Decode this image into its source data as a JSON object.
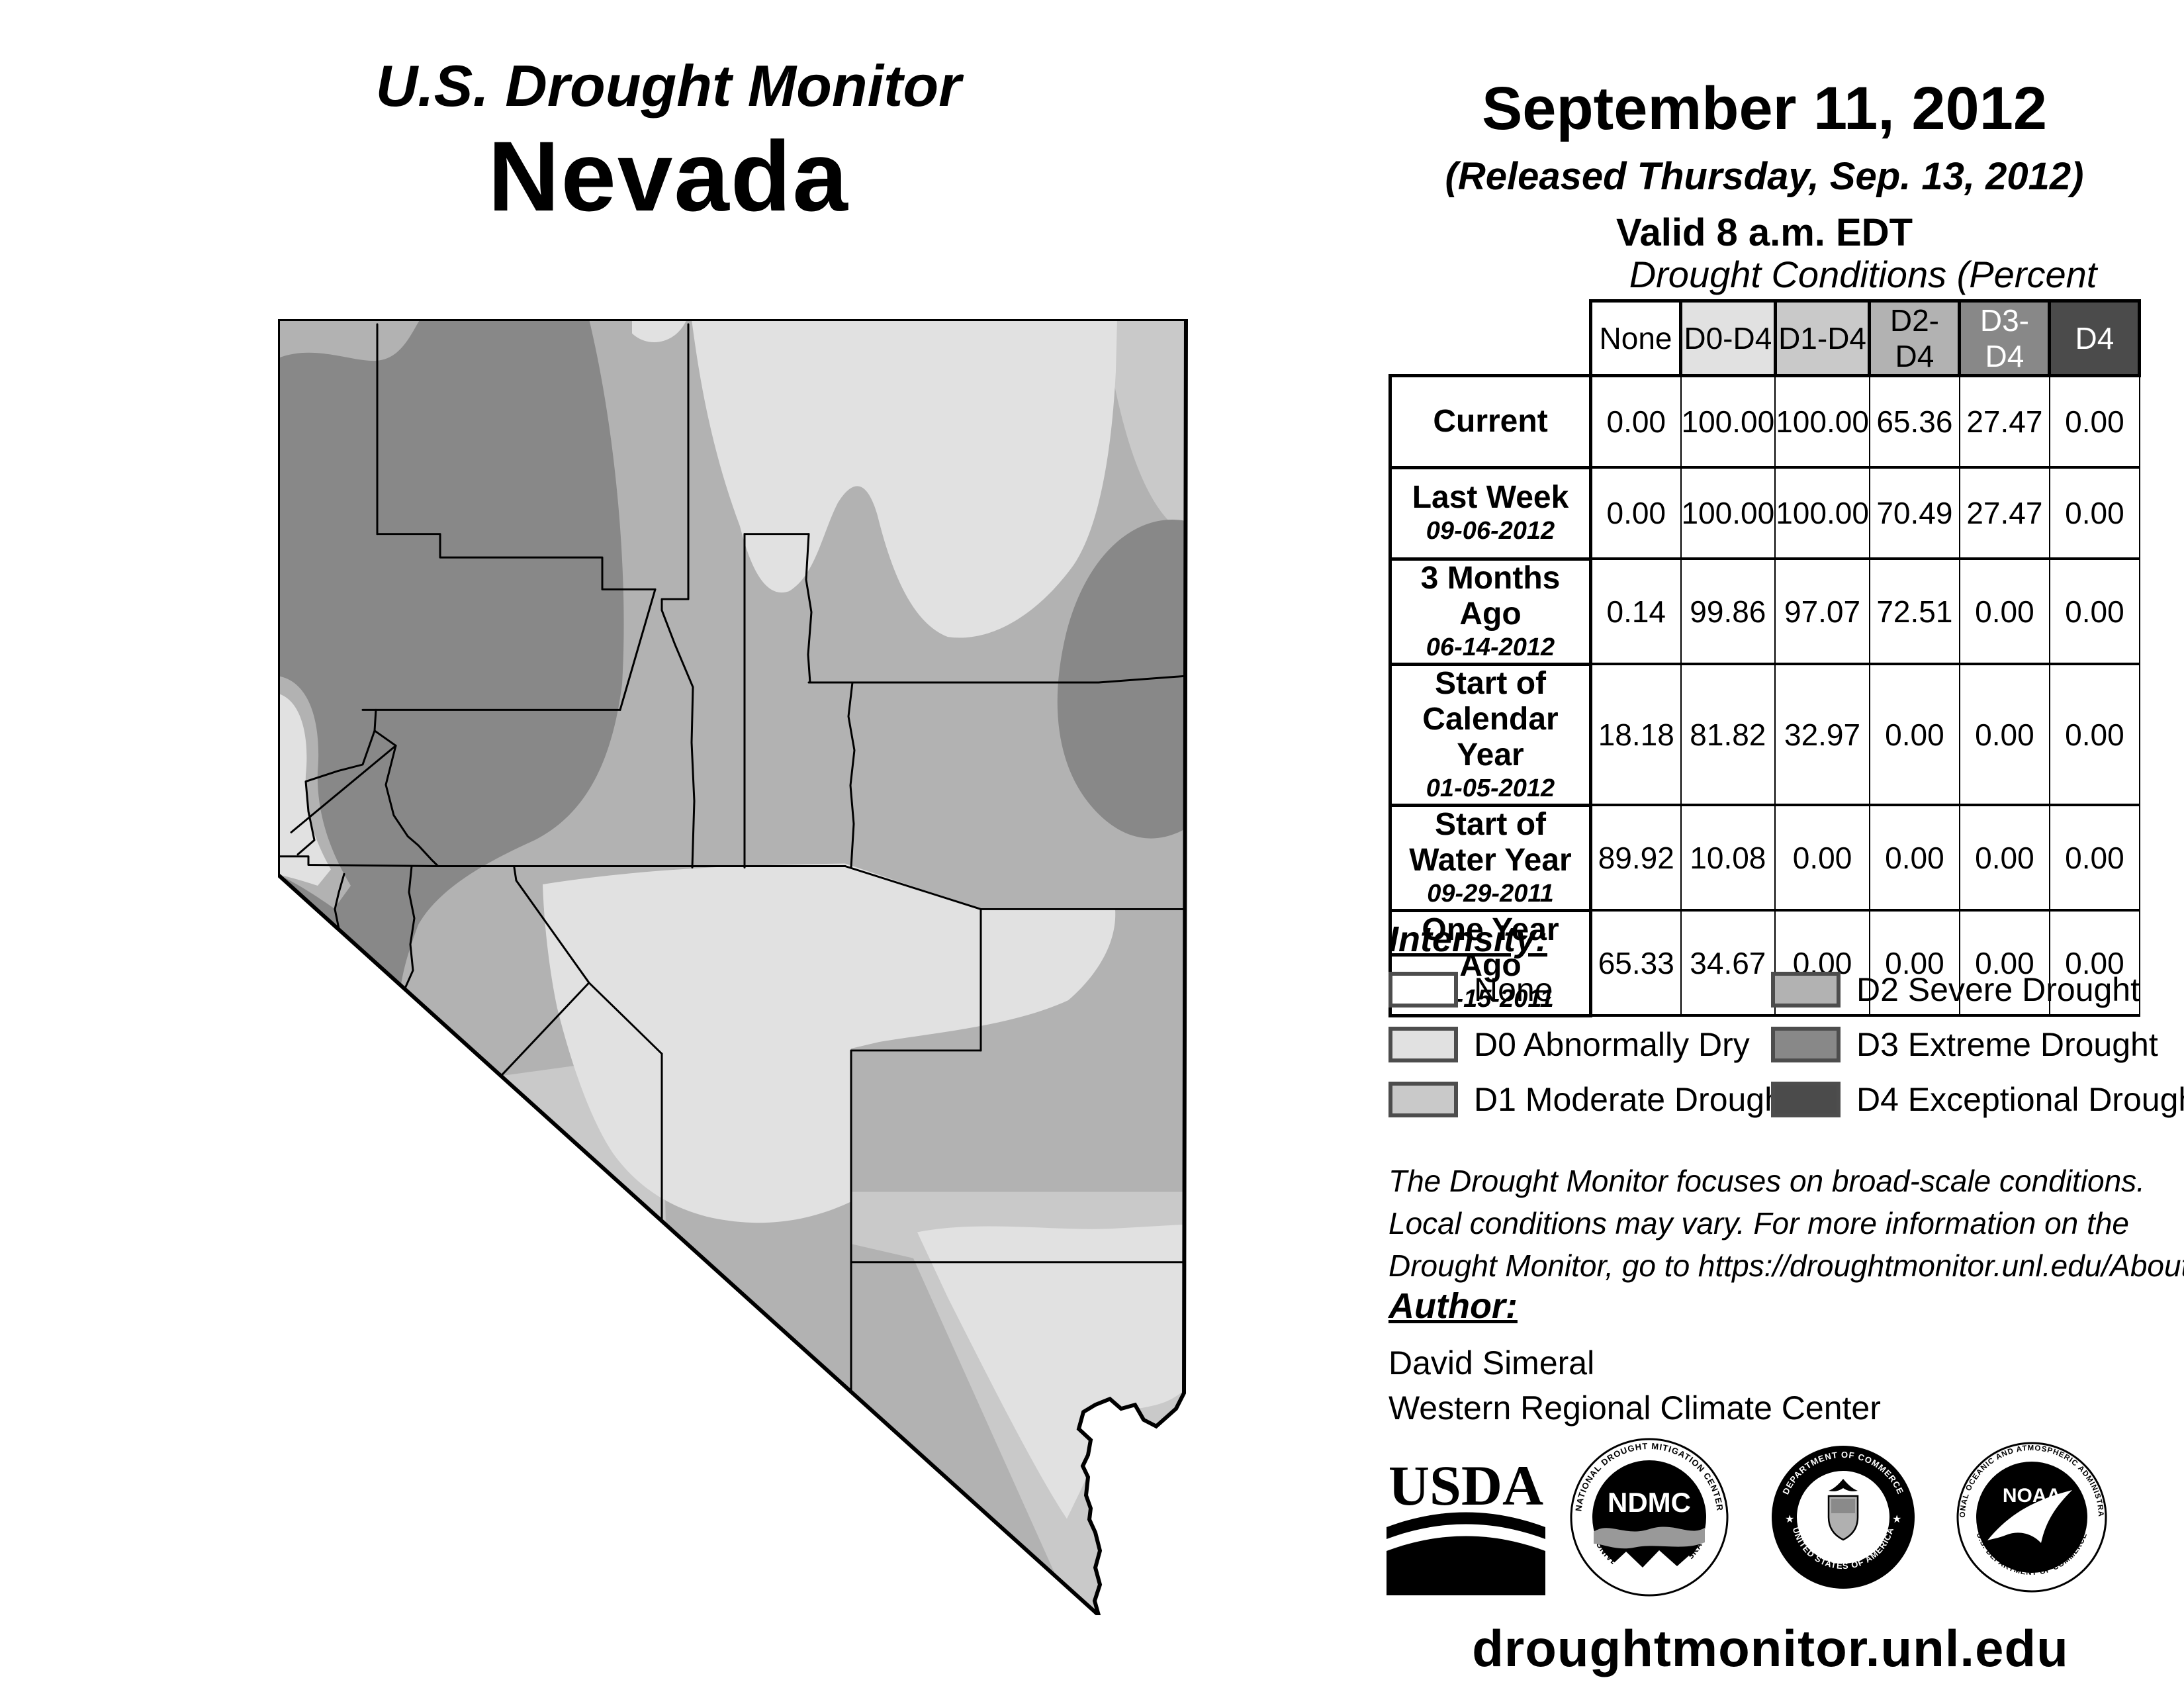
{
  "header": {
    "title": "U.S. Drought Monitor",
    "state": "Nevada",
    "date": "September 11, 2012",
    "released": "(Released Thursday, Sep. 13, 2012)",
    "valid": "Valid 8 a.m. EDT"
  },
  "table": {
    "title": "Drought Conditions (Percent Area)",
    "columns": [
      {
        "label": "None",
        "bg": "#ffffff",
        "fg": "#000000"
      },
      {
        "label": "D0-D4",
        "bg": "#e1e1e1",
        "fg": "#000000"
      },
      {
        "label": "D1-D4",
        "bg": "#c9c9c9",
        "fg": "#000000"
      },
      {
        "label": "D2-D4",
        "bg": "#b2b2b2",
        "fg": "#000000"
      },
      {
        "label": "D3-D4",
        "bg": "#888888",
        "fg": "#ffffff"
      },
      {
        "label": "D4",
        "bg": "#4b4b4b",
        "fg": "#ffffff"
      }
    ],
    "rows": [
      {
        "label": "Current",
        "date": "",
        "values": [
          "0.00",
          "100.00",
          "100.00",
          "65.36",
          "27.47",
          "0.00"
        ]
      },
      {
        "label": "Last Week",
        "date": "09-06-2012",
        "values": [
          "0.00",
          "100.00",
          "100.00",
          "70.49",
          "27.47",
          "0.00"
        ]
      },
      {
        "label": "3 Months Ago",
        "date": "06-14-2012",
        "values": [
          "0.14",
          "99.86",
          "97.07",
          "72.51",
          "0.00",
          "0.00"
        ]
      },
      {
        "label": "Start of|Calendar Year",
        "date": "01-05-2012",
        "values": [
          "18.18",
          "81.82",
          "32.97",
          "0.00",
          "0.00",
          "0.00"
        ]
      },
      {
        "label": "Start of|Water Year",
        "date": "09-29-2011",
        "values": [
          "89.92",
          "10.08",
          "0.00",
          "0.00",
          "0.00",
          "0.00"
        ]
      },
      {
        "label": "One Year Ago",
        "date": "09-15-2011",
        "values": [
          "65.33",
          "34.67",
          "0.00",
          "0.00",
          "0.00",
          "0.00"
        ]
      }
    ],
    "row_label_lines": {
      "r0a": "Current",
      "r0b": "",
      "r1a": "Last Week",
      "r1b": "09-06-2012",
      "r2a": "3 Months Ago",
      "r2b": "06-14-2012",
      "r3a": "Start of",
      "r3a2": "Calendar Year",
      "r3b": "01-05-2012",
      "r4a": "Start of",
      "r4a2": "Water Year",
      "r4b": "09-29-2011",
      "r5a": "One Year Ago",
      "r5b": "09-15-2011"
    }
  },
  "legend": {
    "title": "Intensity:",
    "items": [
      {
        "label": "None",
        "color": "#ffffff"
      },
      {
        "label": "D0 Abnormally Dry",
        "color": "#e1e1e1"
      },
      {
        "label": "D1 Moderate Drought",
        "color": "#c9c9c9"
      },
      {
        "label": "D2 Severe Drought",
        "color": "#b2b2b2"
      },
      {
        "label": "D3 Extreme Drought",
        "color": "#888888"
      },
      {
        "label": "D4 Exceptional Drought",
        "color": "#4b4b4b"
      }
    ]
  },
  "notes": {
    "line1": "The Drought Monitor focuses on broad-scale conditions.",
    "line2": "Local conditions may vary. For more information on the",
    "line3": "Drought Monitor, go to https://droughtmonitor.unl.edu/About.aspx"
  },
  "author": {
    "label": "Author:",
    "name": "David Simeral",
    "org": "Western Regional Climate Center"
  },
  "footer": {
    "url": "droughtmonitor.unl.edu"
  },
  "logos": {
    "usda": {
      "text": "USDA"
    },
    "ndmc": {
      "center": "NDMC",
      "top": "NATIONAL DROUGHT MITIGATION CENTER",
      "bottom": "UNIVERSITY OF NEBRASKA"
    },
    "doc": {
      "top": "DEPARTMENT OF COMMERCE",
      "bottom": "UNITED STATES OF AMERICA"
    },
    "noaa": {
      "center": "NOAA",
      "top": "NATIONAL OCEANIC AND ATMOSPHERIC ADMINISTRATION",
      "bottom": "U.S. DEPARTMENT OF COMMERCE"
    }
  },
  "map": {
    "region": "Nevada",
    "fills": {
      "none": "#ffffff",
      "d0": "#e1e1e1",
      "d1": "#c9c9c9",
      "d2": "#b2b2b2",
      "d3": "#888888",
      "d4": "#4b4b4b"
    }
  }
}
